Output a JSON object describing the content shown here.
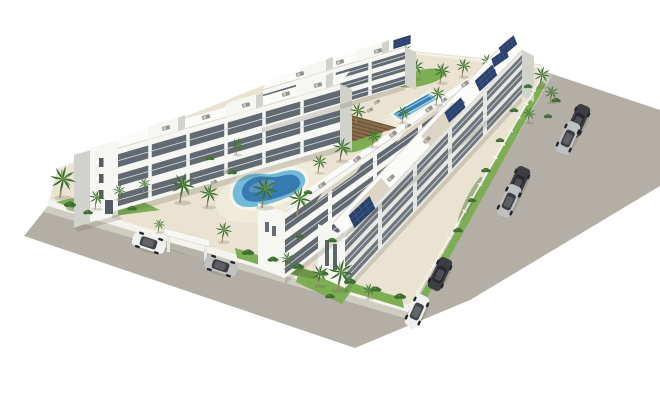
{
  "scene": {
    "description": "Aerial 3D architectural render of a white modern apartment complex with courtyard pools, palm trees, perimeter roads, parked cars, entrance canopy and rooftop solar panels on a white background",
    "features": [
      "white 3-storey apartment blocks with balconies",
      "kidney-shaped lagoon pool",
      "rectangular pool",
      "wooden pergola deck",
      "palm trees and lawns",
      "perimeter asphalt roads",
      "parked cars",
      "rooftop terraces with furniture",
      "solar panel arrays",
      "entrance canopy",
      "white perimeter wall and fence"
    ],
    "palette": {
      "bg": "#ffffff",
      "road": "#b4afa6",
      "sidewalk": "#cfccc2",
      "kerbWall": "#f4f3ee",
      "fence": "#f4f4f0",
      "pavement": "#eae3d2",
      "pavementLight": "#f0ead9",
      "grass": "#7dae54",
      "grassDark": "#587f3a",
      "shrub": "#3e6e33",
      "palmFrond": "#3c6e33",
      "palmFrondLight": "#61953f",
      "palmTrunk": "#9b8a6b",
      "bldFront": "#f6f6f3",
      "bldSide": "#e7e7e3",
      "bldShade": "#d2d2cd",
      "roof": "#fbfbf9",
      "roofLine": "#d8d7d2",
      "roofTerrace": "#ddd5c3",
      "furniture": "#96948c",
      "furnitureLight": "#c9c6bd",
      "window": "#434b55",
      "rail": "#cdd6da",
      "poolLight": "#74bad8",
      "poolDeep": "#2f74ad",
      "poolLane": "#bfe2ee",
      "coping": "#f7f4ea",
      "pergola": "#8a6d4c",
      "pergolaSlat": "#6b5238",
      "solar": "#28406b",
      "solarLine": "#46608f",
      "carWhite": "#f0f1ef",
      "carSilver": "#bfc1c3",
      "carDark": "#3d3e42",
      "carGlass": "#23262c",
      "shadowRGBA": "rgba(90,85,70,0.20)"
    },
    "instances": {
      "palmB": [
        {
          "x": 392,
          "y": 74,
          "s": 0.66
        },
        {
          "x": 414,
          "y": 78,
          "s": 0.66
        },
        {
          "x": 440,
          "y": 82,
          "s": 0.66
        },
        {
          "x": 462,
          "y": 76,
          "s": 0.6
        },
        {
          "x": 486,
          "y": 70,
          "s": 0.55
        },
        {
          "x": 404,
          "y": 58,
          "s": 0.5
        },
        {
          "x": 372,
          "y": 62,
          "s": 0.5
        }
      ],
      "palm": [
        {
          "x": 60,
          "y": 196,
          "s": 1.0
        },
        {
          "x": 95,
          "y": 208,
          "s": 0.62
        },
        {
          "x": 118,
          "y": 199,
          "s": 0.5
        },
        {
          "x": 143,
          "y": 192,
          "s": 0.5
        },
        {
          "x": 180,
          "y": 201,
          "s": 0.95
        },
        {
          "x": 207,
          "y": 206,
          "s": 0.75
        },
        {
          "x": 236,
          "y": 154,
          "s": 0.55
        },
        {
          "x": 262,
          "y": 206,
          "s": 1.0
        },
        {
          "x": 297,
          "y": 214,
          "s": 0.9
        },
        {
          "x": 318,
          "y": 172,
          "s": 0.6
        },
        {
          "x": 222,
          "y": 241,
          "s": 0.65
        },
        {
          "x": 158,
          "y": 232,
          "s": 0.45
        },
        {
          "x": 338,
          "y": 289,
          "s": 1.0
        },
        {
          "x": 318,
          "y": 285,
          "s": 0.7
        },
        {
          "x": 286,
          "y": 268,
          "s": 0.55
        },
        {
          "x": 368,
          "y": 298,
          "s": 0.5
        },
        {
          "x": 340,
          "y": 160,
          "s": 0.75
        },
        {
          "x": 356,
          "y": 122,
          "s": 0.65
        },
        {
          "x": 372,
          "y": 146,
          "s": 0.6
        },
        {
          "x": 402,
          "y": 122,
          "s": 0.55
        },
        {
          "x": 436,
          "y": 104,
          "s": 0.6
        },
        {
          "x": 540,
          "y": 86,
          "s": 0.66
        },
        {
          "x": 550,
          "y": 102,
          "s": 0.56
        },
        {
          "x": 528,
          "y": 122,
          "s": 0.5
        }
      ],
      "shrub": [
        {
          "x": 70,
          "y": 204,
          "s": 1
        },
        {
          "x": 88,
          "y": 212,
          "s": 0.8
        },
        {
          "x": 132,
          "y": 208,
          "s": 0.8
        },
        {
          "x": 248,
          "y": 252,
          "s": 1
        },
        {
          "x": 273,
          "y": 259,
          "s": 0.9
        },
        {
          "x": 298,
          "y": 266,
          "s": 1
        },
        {
          "x": 323,
          "y": 273,
          "s": 0.9
        },
        {
          "x": 350,
          "y": 281,
          "s": 1
        },
        {
          "x": 376,
          "y": 289,
          "s": 0.9
        },
        {
          "x": 400,
          "y": 296,
          "s": 1
        },
        {
          "x": 330,
          "y": 296,
          "s": 0.8
        },
        {
          "x": 420,
          "y": 308,
          "s": 0.8
        },
        {
          "x": 444,
          "y": 260,
          "s": 0.8
        },
        {
          "x": 458,
          "y": 230,
          "s": 0.8
        },
        {
          "x": 472,
          "y": 200,
          "s": 0.7
        },
        {
          "x": 486,
          "y": 170,
          "s": 0.8
        },
        {
          "x": 500,
          "y": 140,
          "s": 0.7
        },
        {
          "x": 514,
          "y": 110,
          "s": 0.7
        },
        {
          "x": 528,
          "y": 86,
          "s": 0.7
        },
        {
          "x": 556,
          "y": 100,
          "s": 0.8
        },
        {
          "x": 548,
          "y": 116,
          "s": 0.7
        },
        {
          "x": 232,
          "y": 172,
          "s": 0.8
        },
        {
          "x": 308,
          "y": 192,
          "s": 0.7
        },
        {
          "x": 210,
          "y": 158,
          "s": 0.7
        },
        {
          "x": 332,
          "y": 240,
          "s": 0.8
        },
        {
          "x": 300,
          "y": 236,
          "s": 0.7
        }
      ],
      "furn": [
        {
          "x": 166,
          "y": 128,
          "r": -16
        },
        {
          "x": 206,
          "y": 117,
          "r": -16
        },
        {
          "x": 246,
          "y": 105,
          "r": -16
        },
        {
          "x": 286,
          "y": 94,
          "r": -16
        },
        {
          "x": 318,
          "y": 85,
          "r": -16
        },
        {
          "x": 300,
          "y": 74,
          "r": -17
        },
        {
          "x": 340,
          "y": 62,
          "r": -17
        },
        {
          "x": 378,
          "y": 51,
          "r": -17
        },
        {
          "x": 322,
          "y": 185,
          "r": -35
        },
        {
          "x": 357,
          "y": 159,
          "r": -35
        },
        {
          "x": 393,
          "y": 134,
          "r": -35
        },
        {
          "x": 429,
          "y": 109,
          "r": -35
        },
        {
          "x": 465,
          "y": 84,
          "r": -35
        },
        {
          "x": 354,
          "y": 218,
          "r": -43
        },
        {
          "x": 391,
          "y": 178,
          "r": -43
        },
        {
          "x": 427,
          "y": 140,
          "r": -43
        },
        {
          "x": 461,
          "y": 104,
          "r": -43
        },
        {
          "x": 492,
          "y": 72,
          "r": -43
        },
        {
          "x": 214,
          "y": 182,
          "r": -20,
          "s": 0.75
        },
        {
          "x": 209,
          "y": 192,
          "r": -20,
          "s": 0.75
        },
        {
          "x": 226,
          "y": 172,
          "r": -20,
          "s": 0.7
        },
        {
          "x": 377,
          "y": 102,
          "r": -30,
          "s": 0.75
        },
        {
          "x": 370,
          "y": 110,
          "r": -30,
          "s": 0.75
        },
        {
          "x": 444,
          "y": 100,
          "r": -30,
          "s": 0.75
        },
        {
          "x": 408,
          "y": 126,
          "r": -30,
          "s": 0.75
        }
      ],
      "solar": [
        {
          "x": 362,
          "y": 212,
          "s": 0.95,
          "r": -43
        },
        {
          "x": 455,
          "y": 110,
          "s": 0.75,
          "r": -43
        },
        {
          "x": 486,
          "y": 78,
          "s": 0.8,
          "r": -43
        },
        {
          "x": 508,
          "y": 46,
          "s": 0.65,
          "r": -40
        },
        {
          "x": 500,
          "y": 58,
          "s": 0.6,
          "r": -35
        },
        {
          "x": 402,
          "y": 42,
          "s": 0.6,
          "r": -17
        }
      ],
      "car": [
        {
          "x": 149,
          "y": 243,
          "r": 18,
          "c": "carWhite"
        },
        {
          "x": 221,
          "y": 266,
          "r": 18,
          "c": "carSilver"
        },
        {
          "x": 578,
          "y": 121,
          "r": -65,
          "c": "carDark"
        },
        {
          "x": 568,
          "y": 138,
          "r": -65,
          "c": "carSilver"
        },
        {
          "x": 518,
          "y": 183,
          "r": -65,
          "c": "carDark"
        },
        {
          "x": 509,
          "y": 201,
          "r": -65,
          "c": "carSilver"
        },
        {
          "x": 440,
          "y": 274,
          "r": -65,
          "c": "carDark"
        },
        {
          "x": 417,
          "y": 311,
          "r": -65,
          "c": "carWhite"
        }
      ]
    }
  }
}
